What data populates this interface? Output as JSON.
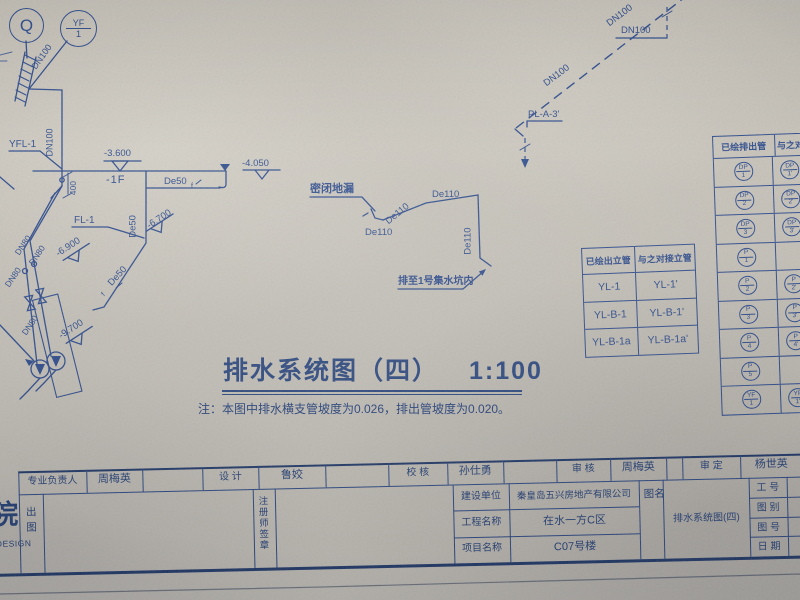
{
  "colors": {
    "ink": "#2d4b8c",
    "ink_dark": "#223e74",
    "paper": "#c6c2b9"
  },
  "symbols": {
    "q": "Q",
    "yf_top": "YF",
    "yf_bottom": "1"
  },
  "pipe_labels": {
    "dn100_hatch": "DN100",
    "dn100_riser": "DN100",
    "yfl1": "YFL-1",
    "elev_3600": "-3.600",
    "floor_1f": "-1F",
    "dim_400": "400",
    "de50_floor": "De50",
    "de50_floor_sub": "f",
    "elev_4050": "-4.050",
    "fl1": "FL-1",
    "de50_riser": "De50",
    "elev_6700": "-6.700",
    "de50_diag": "De50",
    "de50_diag_sub": "f",
    "elev_6900": "-6.900",
    "dn80_1": "DN80",
    "dn80_2": "DN80",
    "dn80_3": "DN80",
    "dn80_4": "DN80",
    "elev_9700": "-9.700",
    "floor_drain": "密闭地漏",
    "de110_diag": "De110",
    "de110_top": "De110",
    "de110_vert": "De110",
    "de110_bottom": "De110",
    "sump_note": "排至1号集水坑内",
    "dn100_diag1": "DN100",
    "dn100_diag2": "DN100",
    "dn100_h": "DN100",
    "pl_a3": "PL-A-3'"
  },
  "title": {
    "text": "排水系统图（四）",
    "scale": "1:100"
  },
  "note": "注：本图中排水横支管坡度为0.026，排出管坡度为0.020。",
  "riser_table": {
    "headers": [
      "已绘出立管",
      "与之对接立管"
    ],
    "rows": [
      [
        "YL-1",
        "YL-1'"
      ],
      [
        "YL-B-1",
        "YL-B-1'"
      ],
      [
        "YL-B-1a",
        "YL-B-1a'"
      ]
    ]
  },
  "outlet_table": {
    "headers": [
      "已绘排出管",
      "与之对接"
    ],
    "rows": [
      {
        "left": [
          "DP",
          "1"
        ],
        "right": [
          "DP",
          "1'"
        ]
      },
      {
        "left": [
          "DP",
          "2"
        ],
        "right": [
          "DP",
          "2'"
        ]
      },
      {
        "left": [
          "DP",
          "3"
        ],
        "right": [
          "DP",
          "3'"
        ]
      },
      {
        "left": [
          "P",
          "1"
        ]
      },
      {
        "left": [
          "P",
          "2"
        ],
        "right": [
          "P",
          "2'"
        ]
      },
      {
        "left": [
          "P",
          "3"
        ],
        "right": [
          "P",
          "3'"
        ]
      },
      {
        "left": [
          "P",
          "4"
        ],
        "right": [
          "P",
          "4'"
        ]
      },
      {
        "left": [
          "P",
          "5"
        ]
      },
      {
        "left": [
          "YF",
          "1"
        ],
        "right": [
          "YF",
          "1'"
        ]
      }
    ]
  },
  "title_block": {
    "labels": {
      "lead": "专业负责人",
      "design": "设  计",
      "check": "校  核",
      "review": "审  核",
      "approve": "审  定",
      "client": "建设单位",
      "project": "工程名称",
      "item": "项目名称",
      "job_no": "工 号",
      "fig_type": "图 别",
      "fig_no": "图 号",
      "date": "日 期",
      "publish": "出图",
      "seal": "注册师签章",
      "fig_name": "图名",
      "inst_cn": "院",
      "inst_en": "DESIGN"
    },
    "values": {
      "lead": "周梅英",
      "design": "鲁姣",
      "check": "孙仕勇",
      "review": "周梅英",
      "approve": "杨世英",
      "client": "秦皇岛五兴房地产有限公司",
      "project": "在水一方C区",
      "item": "C07号楼",
      "drawing_name": "排水系统图(四)"
    }
  }
}
